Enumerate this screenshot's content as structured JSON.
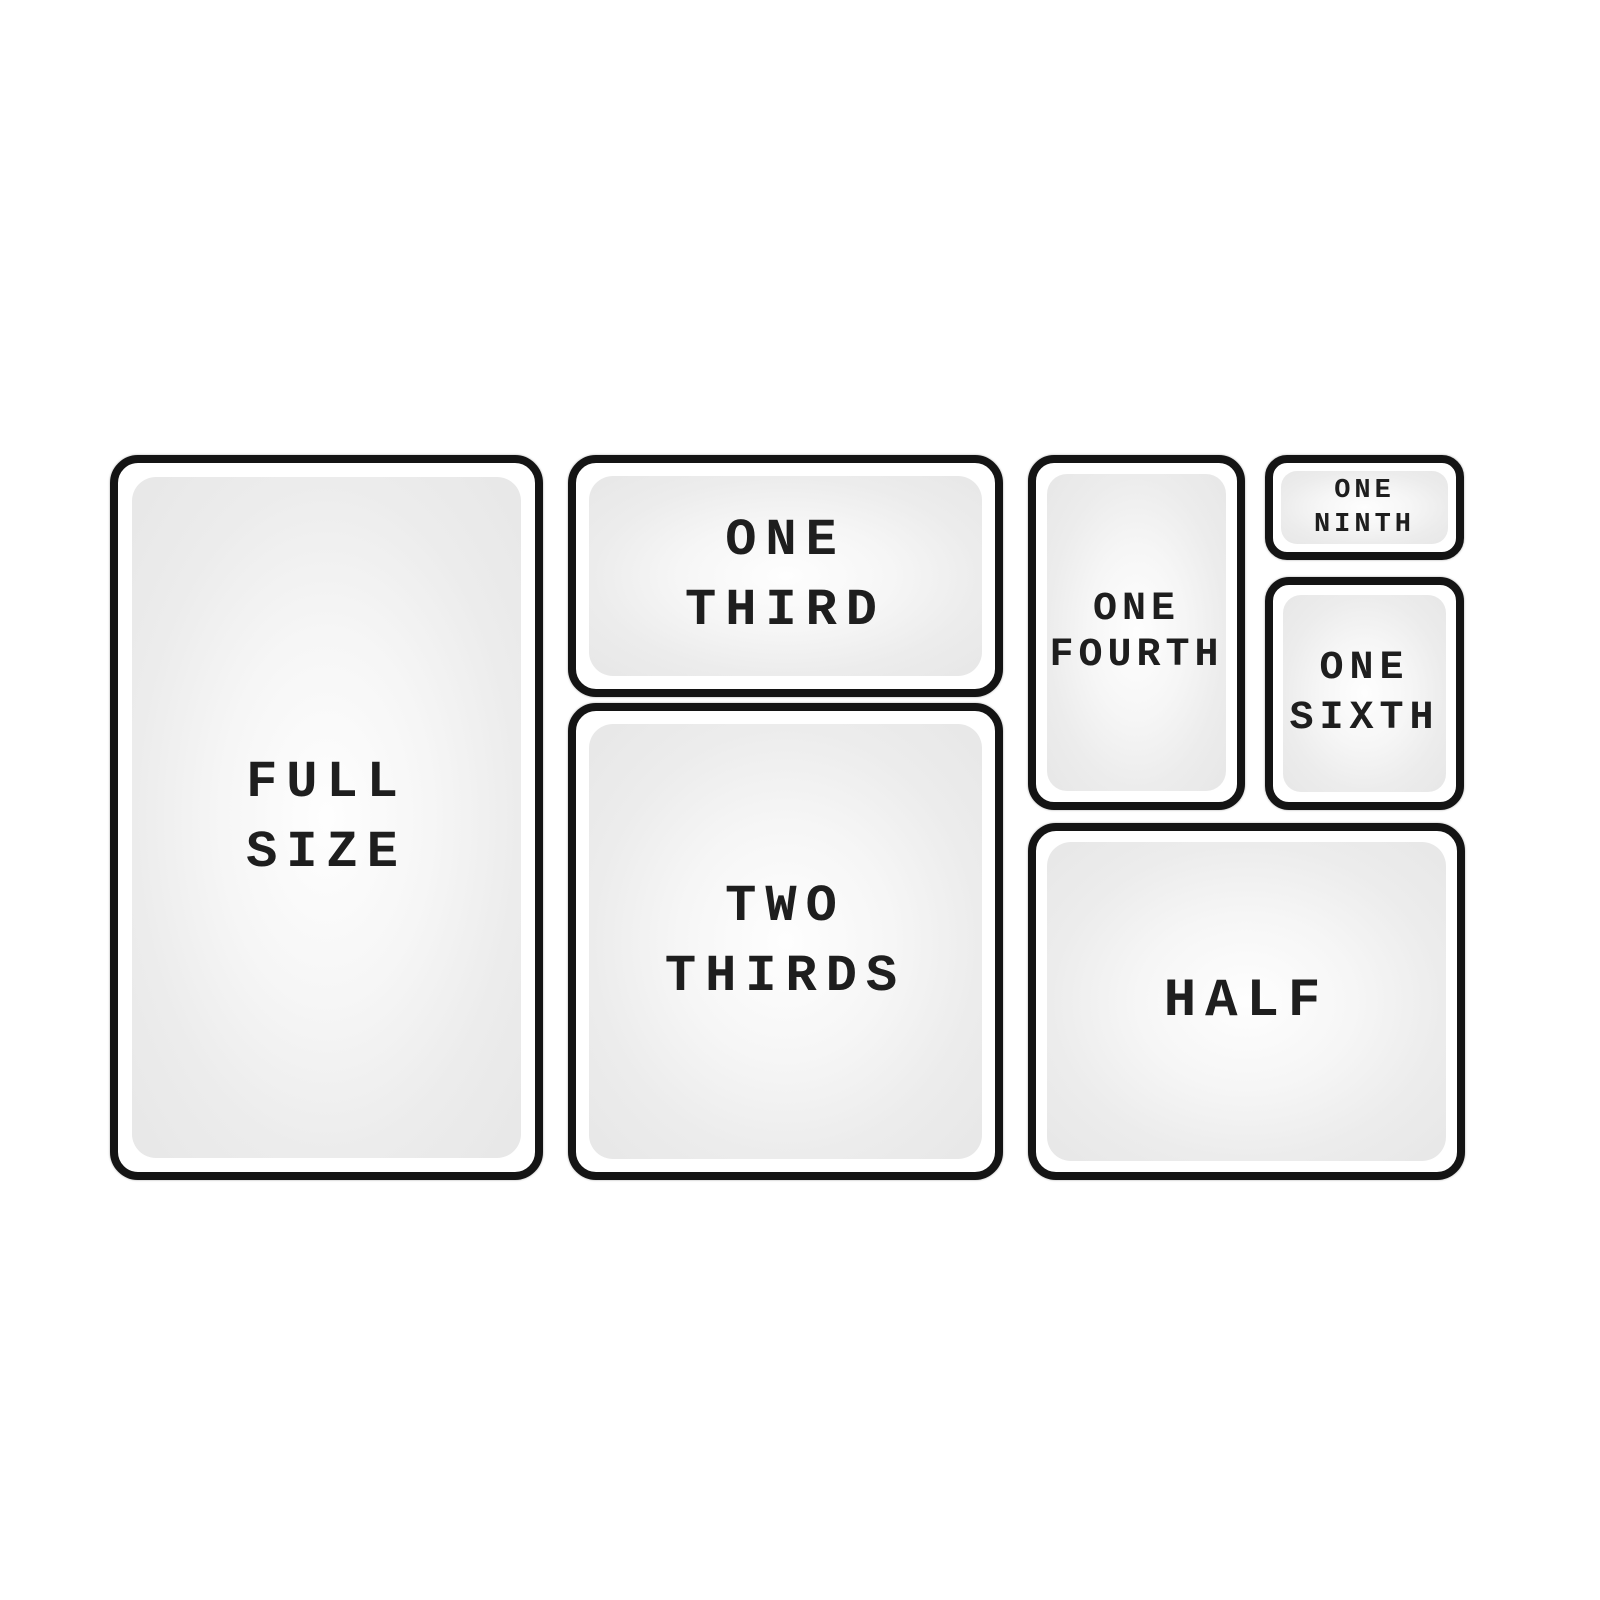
{
  "diagram": {
    "subject": "steam-table pan size chart",
    "colors": {
      "background": "#ffffff",
      "pan_border": "#141414",
      "pan_fill_edge": "#e7e7e7",
      "pan_fill_center": "#fefefe",
      "label_text": "#1e1e1e"
    },
    "pans": {
      "full": {
        "label": "FULL\nSIZE"
      },
      "one_third": {
        "label": "ONE\nTHIRD"
      },
      "two_thirds": {
        "label": "TWO\nTHIRDS"
      },
      "one_fourth": {
        "label": "ONE\nFOURTH"
      },
      "one_ninth": {
        "label": "ONE\nNINTH"
      },
      "one_sixth": {
        "label": "ONE\nSIXTH"
      },
      "half": {
        "label": "HALF"
      }
    }
  }
}
